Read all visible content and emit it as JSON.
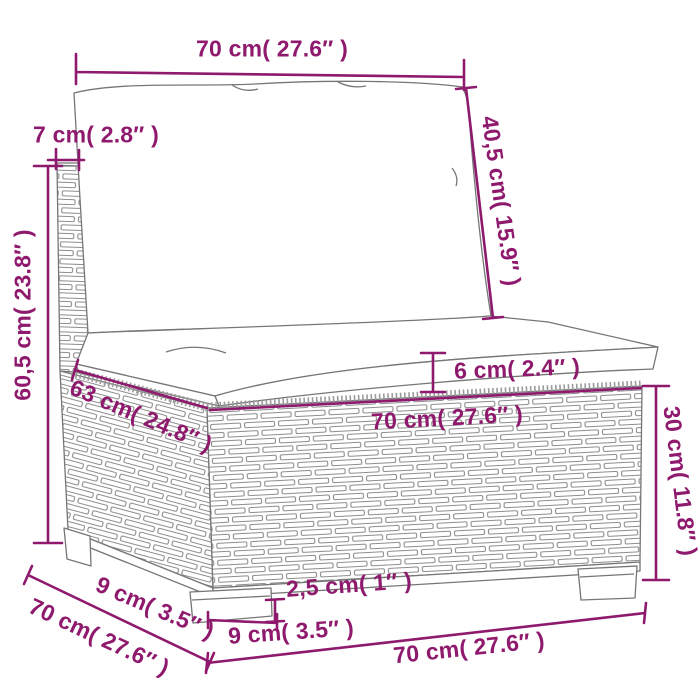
{
  "colors": {
    "dim": "#8E196D",
    "line": "#767676",
    "wicker_stroke": "#8d8d8d",
    "background": "#ffffff"
  },
  "dims": {
    "back_width": "70 cm( 27.6″ )",
    "back_cushion_height": "40,5 cm( 15.9″ )",
    "back_frame_thickness": "7 cm( 2.8″ )",
    "total_height": "60,5 cm( 23.8″ )",
    "seat_cushion_thickness": "6 cm( 2.4″ )",
    "seat_depth": "63 cm( 24.8″ )",
    "seat_width": "70 cm( 27.6″ )",
    "base_height": "30 cm( 11.8″ )",
    "foot_depth": "9 cm( 3.5″ )",
    "base_depth": "70 cm( 27.6″ )",
    "leg_height": "2,5 cm( 1″ )",
    "foot_width": "9 cm( 3.5″ )",
    "base_width": "70 cm( 27.6″ )"
  }
}
